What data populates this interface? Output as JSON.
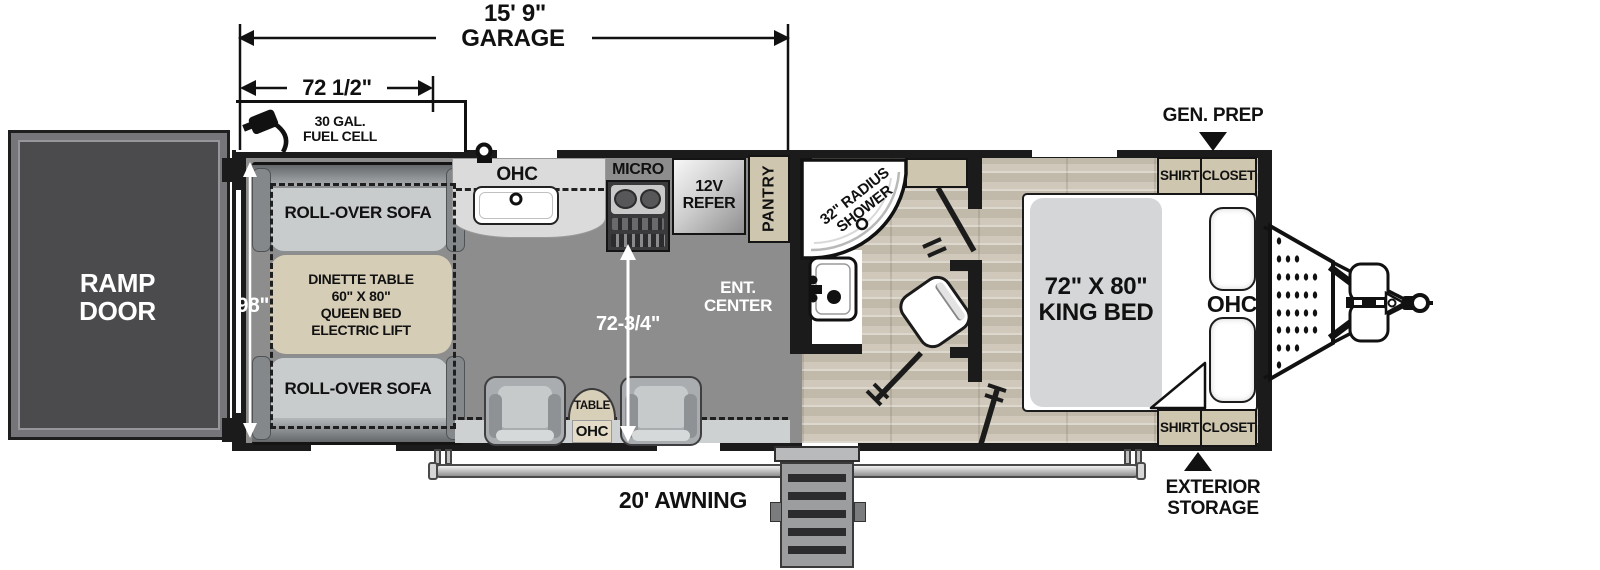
{
  "dimensions": {
    "garage_length": "15' 9\"",
    "garage_word": "GARAGE",
    "front_section": "72 1/2\"",
    "interior_width": "98\"",
    "galley_span": "72-3/4\""
  },
  "exterior": {
    "fuel_line1": "30 GAL.",
    "fuel_line2": "FUEL CELL",
    "gen_prep": "GEN. PREP",
    "ext_storage_line1": "EXTERIOR",
    "ext_storage_line2": "STORAGE",
    "awning": "20' AWNING"
  },
  "garage": {
    "ramp_line1": "RAMP",
    "ramp_line2": "DOOR",
    "sofa_top": "ROLL-OVER SOFA",
    "sofa_bottom": "ROLL-OVER SOFA",
    "dinette_line1": "DINETTE TABLE",
    "dinette_line2": "60\" X 80\"",
    "dinette_line3": "QUEEN BED",
    "dinette_line4": "ELECTRIC LIFT",
    "ohc": "OHC",
    "micro": "MICRO",
    "refer_line1": "12V",
    "refer_line2": "REFER",
    "pantry": "PANTRY",
    "ent_line1": "ENT.",
    "ent_line2": "CENTER",
    "table": "TABLE",
    "table_ohc": "OHC"
  },
  "bathroom": {
    "shower_line1": "32\" RADIUS",
    "shower_line2": "SHOWER"
  },
  "bedroom": {
    "bed_line1": "72\" X 80\"",
    "bed_line2": "KING BED",
    "ohc": "OHC",
    "closet_top_line1": "SHIRT",
    "closet_top_line2": "CLOSET",
    "closet_bottom_line1": "SHIRT",
    "closet_bottom_line2": "CLOSET"
  },
  "colors": {
    "wall": "#1b1b1b",
    "garage_floor": "#8d8d8d",
    "wood_floor": "#cbc3b5",
    "cabinet_beige": "#cfc6b0",
    "dinette_beige": "#d6cdb7",
    "sofa_gray": "#c8cccd",
    "ramp_door": "#4b4b4d",
    "mattress": "#d4d6d8"
  }
}
